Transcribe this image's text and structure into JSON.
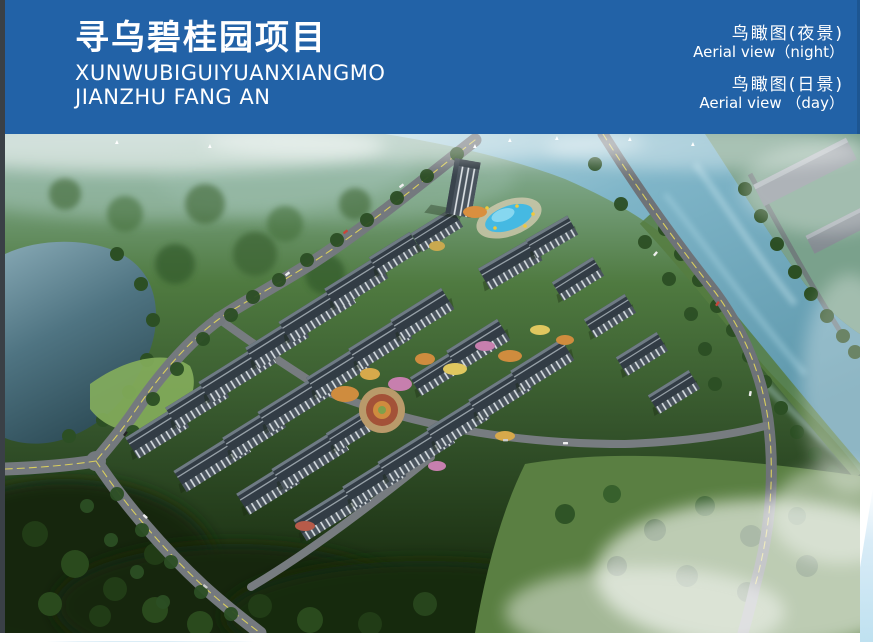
{
  "header": {
    "title_cn": "寻乌碧桂园项目",
    "subtitle_line1": "XUNWUBIGUIYUANXIANGMO",
    "subtitle_line2": "JIANZHU FANG AN",
    "views": [
      {
        "label_cn": "鸟瞰图(夜景)",
        "label_en": "Aerial view（night）"
      },
      {
        "label_cn": "鸟瞰图(日景)",
        "label_en": "Aerial view （day）"
      }
    ]
  },
  "colors": {
    "header_bg": "#2262a7",
    "footer_wave_light": "#cfe7f3",
    "footer_wave_accent": "#8fcce0"
  }
}
